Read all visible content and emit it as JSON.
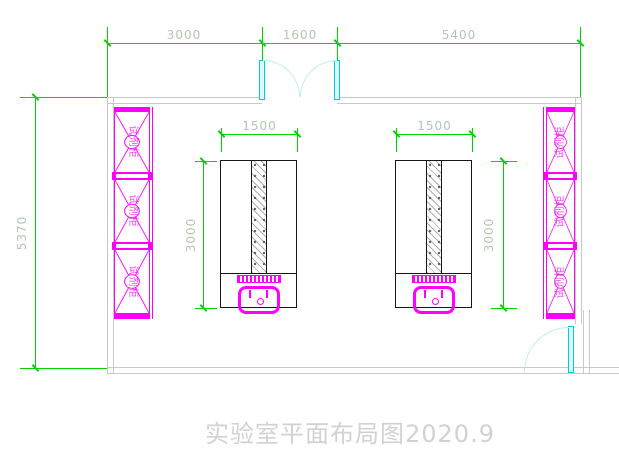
{
  "drawing": {
    "title": "实验室平面布局图2020.9",
    "type": "laboratory floor plan"
  },
  "dimensions": {
    "top": [
      "3000",
      "1600",
      "5400"
    ],
    "left": "5370"
  },
  "benches": [
    {
      "width": "1500",
      "depth": "3000"
    },
    {
      "width": "1500",
      "depth": "3000"
    }
  ],
  "cabinets": {
    "left": {
      "cells": [
        {
          "label": "试剂柜"
        },
        {
          "label": "试剂柜"
        },
        {
          "label": "试剂柜"
        }
      ]
    },
    "right": {
      "cells": [
        {
          "label": "试剂柜"
        },
        {
          "label": "试剂柜"
        },
        {
          "label": "试剂柜"
        }
      ]
    }
  },
  "colors": {
    "dimension_green": "#00d400",
    "dimension_text": "#b3c6b3",
    "fixture_magenta": "#ff00ff",
    "door_cyan": "#00ccda",
    "door_arc_cyan": "#bfeef2",
    "wall_gray": "#c9c9c9",
    "bench_black": "#161616",
    "title_gray": "#d2d2d2"
  }
}
